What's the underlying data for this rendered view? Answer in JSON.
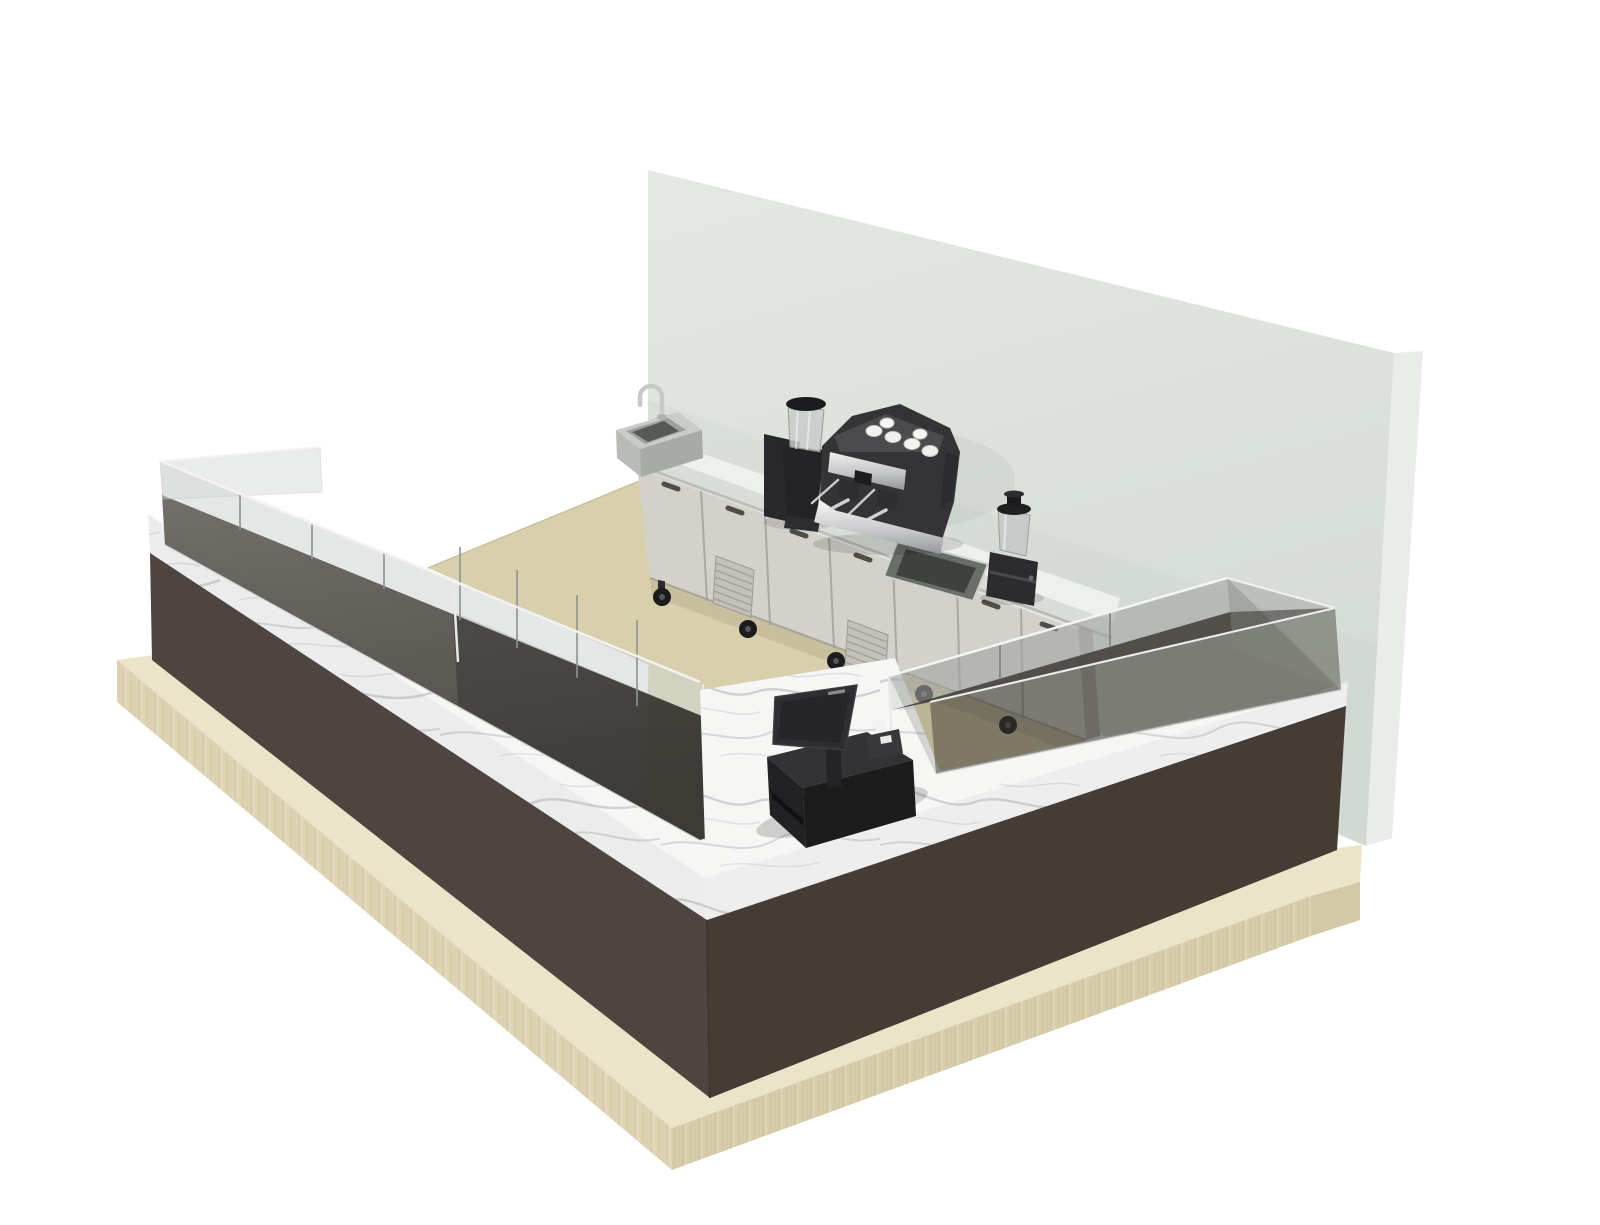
{
  "scene": {
    "type": "3d-render",
    "setting": "coffee-shop bar counter island",
    "view": "isometric-perspective",
    "title": "3D render of a cafe counter: U-shaped dark counter with marble top and glass display cases, back counter with refrigerated cabinets, espresso machine, grinder, blender, sinks and POS terminal against a grey wall",
    "objects": [
      {
        "name": "back-wall",
        "label": "free-standing grey wall panel"
      },
      {
        "name": "floor-slab",
        "label": "beige interior floor"
      },
      {
        "name": "wood-platform",
        "label": "light wood plinth under counters"
      },
      {
        "name": "front-counter",
        "label": "U-shaped dark brown counter with white marble top"
      },
      {
        "name": "left-display-case",
        "label": "smoked glass display case, two bins"
      },
      {
        "name": "right-display-case",
        "label": "smoked glass display case"
      },
      {
        "name": "refrigerated-cabinets",
        "label": "stainless under-counter refrigerated cabinets on casters"
      },
      {
        "name": "back-countertop",
        "label": "white back counter worktop"
      },
      {
        "name": "hand-sink",
        "label": "stainless sink with gooseneck faucet"
      },
      {
        "name": "drop-in-sink",
        "label": "drop-in rinse sink"
      },
      {
        "name": "espresso-machine",
        "label": "two-group espresso machine with cups"
      },
      {
        "name": "coffee-grinder",
        "label": "coffee grinder with clear hopper"
      },
      {
        "name": "blender",
        "label": "countertop blender"
      },
      {
        "name": "pos-terminal",
        "label": "POS terminal with stand, cash base and card reader"
      }
    ]
  },
  "colors": {
    "background": "#ffffff",
    "wall": "#dde2dd",
    "wall_shade": "#cfd5cf",
    "wall_return": "#e9ece8",
    "floor": "#d8d0ac",
    "floor_edge": "#c9c09c",
    "platform_top": "#ebe4c8",
    "platform_front_left": "#ded4b4",
    "platform_front_right": "#d7cdab",
    "platform_end": "#d2c8a5",
    "counter_front_left": "#4e4440",
    "counter_front_right": "#453c36",
    "cabinet_body": "#d2d1ca",
    "cabinet_edge": "#a9a8a2",
    "cabinet_end": "#b3b2ac",
    "countertop_back": "#eef0ed",
    "countertop_edge": "#dadcd9",
    "equipment_dark": "#343436",
    "chrome_light": "#e8e8e8",
    "chrome_dark": "#9fa0a2",
    "glass_band": "#d0d4d2",
    "case_interior": "#54514c",
    "pos_dark": "#2b2b2d",
    "sink_steel": "#b9bbb8",
    "caster": "#1c1c1e"
  }
}
